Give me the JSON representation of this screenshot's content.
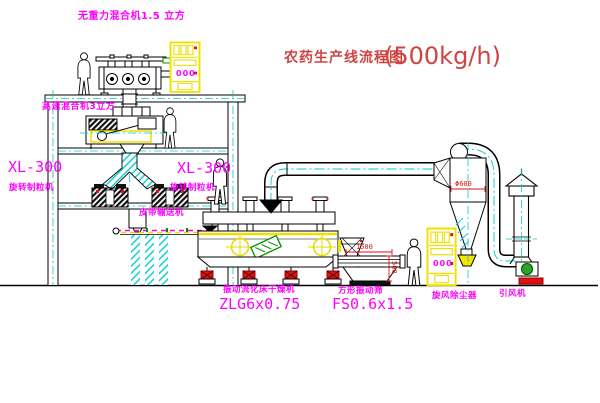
{
  "title": {
    "zh": "农药生产线流程图",
    "capacity": "(500kg/h)"
  },
  "labels": {
    "top_mixer": "无重力混合机1.5 立方",
    "mid_mixer": "高速混合机3立方",
    "granulator_left_model": "XL-300",
    "granulator_left_name": "旋转制粒机",
    "granulator_right_model": "XL-300",
    "granulator_right_name": "旋转制粒机",
    "belt_conveyor": "皮带输送机",
    "dryer_name": "振动流化床干燥机",
    "dryer_model": "ZLG6x0.75",
    "screen_name": "方形振动筛",
    "screen_model": "FS0.6x1.5",
    "cyclone": "旋风除尘器",
    "fan": "引风机"
  },
  "dimensions": {
    "screen_length": "1500",
    "screen_height": "500",
    "cyclone_diameter": "Φ600"
  },
  "control_cabinets": {
    "cabinet1_display": "000",
    "cabinet2_display": "000"
  },
  "colors": {
    "label_magenta": "#FF00FF",
    "dimension_red": "#E01010",
    "title_red": "#CF4343",
    "centerline_cyan": "#00CCCC",
    "equipment_yellow": "#F0E000",
    "motor_green": "#009000"
  }
}
